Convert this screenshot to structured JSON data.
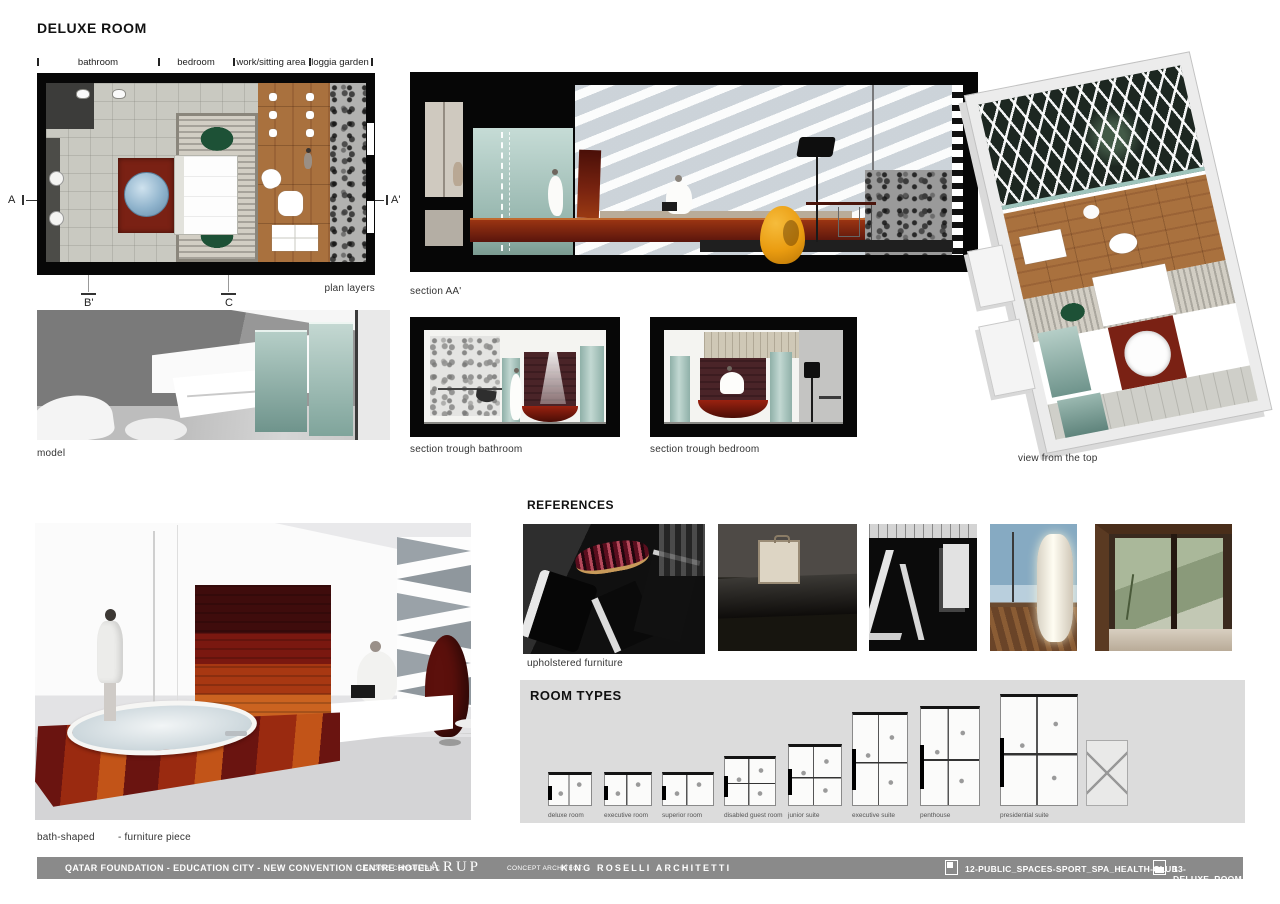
{
  "page": {
    "title": "DELUXE ROOM"
  },
  "plan": {
    "zone_labels": [
      "bathroom",
      "bedroom",
      "work/sitting area",
      "loggia garden"
    ],
    "marker_left": "A",
    "marker_right": "A'",
    "marker_b": "B'",
    "marker_c": "C",
    "caption": "plan layers"
  },
  "sections": {
    "aa_caption": "section AA'",
    "bathroom_caption": "section trough bathroom",
    "bedroom_caption": "section trough bedroom"
  },
  "model": {
    "caption": "model"
  },
  "top_view": {
    "caption": "view from the top"
  },
  "bath_render": {
    "caption_name": "bath-shaped",
    "caption_desc": "- furniture piece"
  },
  "references": {
    "title": "REFERENCES",
    "caption": "upholstered furniture",
    "photos": [
      {
        "name": "dark-furniture-showroom"
      },
      {
        "name": "bench-with-travel-case"
      },
      {
        "name": "black-white-interior-profiles"
      },
      {
        "name": "illuminated-column-lamp"
      },
      {
        "name": "timber-window-view"
      }
    ]
  },
  "room_types": {
    "title": "ROOM TYPES",
    "items": [
      {
        "label": "deluxe room"
      },
      {
        "label": "executive room"
      },
      {
        "label": "superior room"
      },
      {
        "label": "disabled guest room"
      },
      {
        "label": "junior suite"
      },
      {
        "label": "executive suite"
      },
      {
        "label": "penthouse"
      },
      {
        "label": "presidential suite"
      }
    ]
  },
  "footer": {
    "project_title": "QATAR FOUNDATION - EDUCATION CITY - NEW CONVENTION CENTRE HOTEL",
    "leading_consultant_label": "LEADING CONSULTANT:",
    "leading_consultant_name": "ARUP",
    "concept_architect_label": "CONCEPT ARCHITECT:",
    "concept_architect_name": "KING ROSELLI ARCHITETTI",
    "sheet_refs": [
      {
        "label": "12-PUBLIC_SPACES-SPORT_SPA_HEALTH-CLUB"
      },
      {
        "label": "13-DELUXE_ROOM"
      }
    ]
  },
  "colors": {
    "footer_bar": "#8a8a8a",
    "room_types_panel": "#dcdcdc",
    "frame_black": "#070707",
    "glass_teal": "#a9c9c1",
    "wood_red_dark": "#6a1410",
    "wood_red_orange": "#c25418",
    "chair_orange": "#ea9c10",
    "rug_green": "#1d5136",
    "floor_wood": "#a8713f"
  }
}
